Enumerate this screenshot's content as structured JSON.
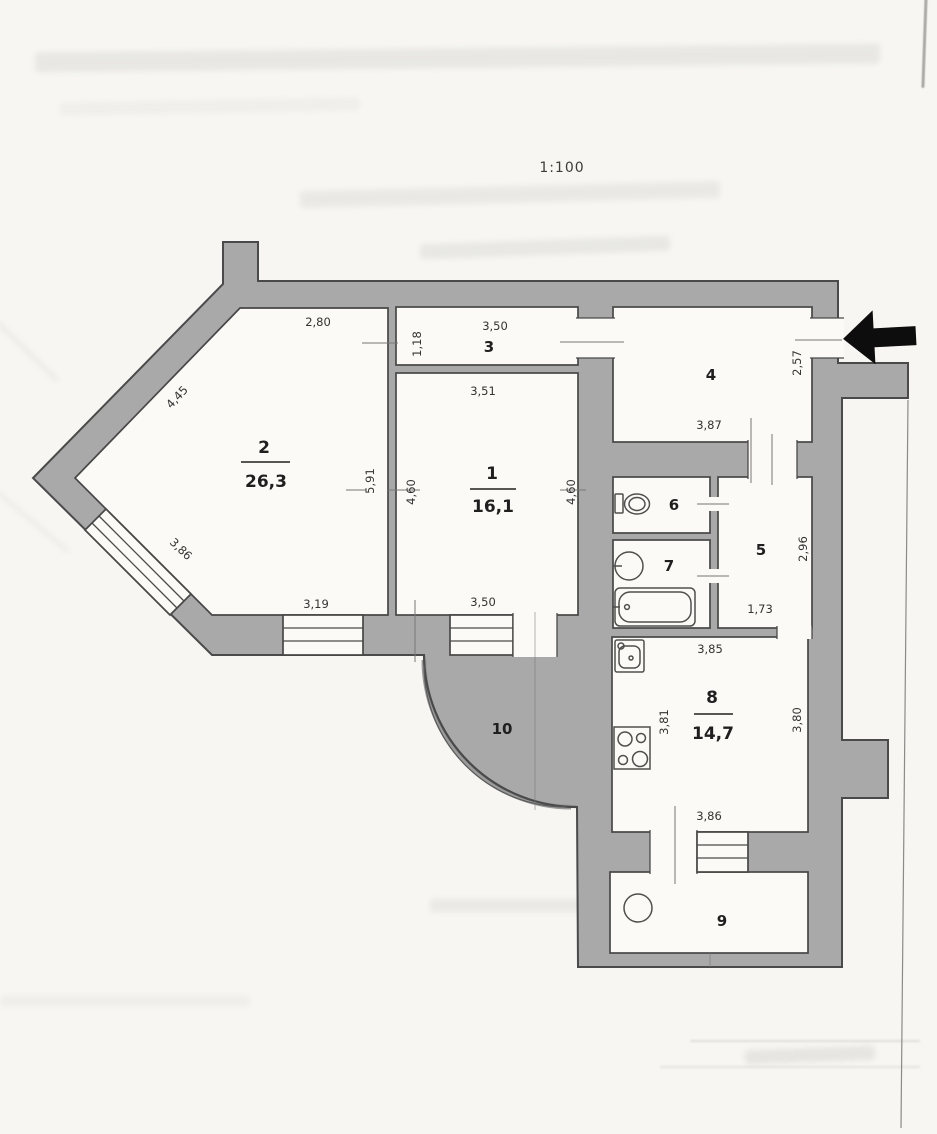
{
  "page": {
    "scale_label": "1:100"
  },
  "plan": {
    "rooms": [
      {
        "number": "1",
        "area": "16,1"
      },
      {
        "number": "2",
        "area": "26,3"
      },
      {
        "number": "3",
        "area": ""
      },
      {
        "number": "4",
        "area": ""
      },
      {
        "number": "5",
        "area": ""
      },
      {
        "number": "6",
        "area": ""
      },
      {
        "number": "7",
        "area": ""
      },
      {
        "number": "8",
        "area": "14,7"
      },
      {
        "number": "9",
        "area": ""
      },
      {
        "number": "10",
        "area": ""
      }
    ],
    "dimensions": {
      "room2_top": "2,80",
      "room3_height": "1,18",
      "room3_width": "3,50",
      "room1_width_top": "3,51",
      "diag_wall_upper": "4,45",
      "diag_window": "3,86",
      "room2_height": "5,91",
      "room1_height_left": "4,60",
      "room1_height_right": "4,60",
      "room2_window_bottom": "3,19",
      "room1_width_bottom": "3,50",
      "room4_height": "2,57",
      "room4_width": "3,87",
      "room5_height": "2,96",
      "room5_width": "1,73",
      "kitchen_top": "3,85",
      "kitchen_left": "3,81",
      "kitchen_right": "3,80",
      "kitchen_bottom": "3,86"
    },
    "icons": {
      "entrance_arrow": "left-arrow",
      "toilet": "toilet-icon",
      "washbasin": "round-sink-icon",
      "bathtub": "bathtub-icon",
      "kitchen_sink": "kitchen-sink-icon",
      "stove": "stove-icon",
      "balcony_circle": "column-icon"
    },
    "colors": {
      "wall": "#a9a9a9",
      "line": "#4a4a4a",
      "paper": "#f7f6f2",
      "arrow": "#0d0d0d"
    }
  }
}
